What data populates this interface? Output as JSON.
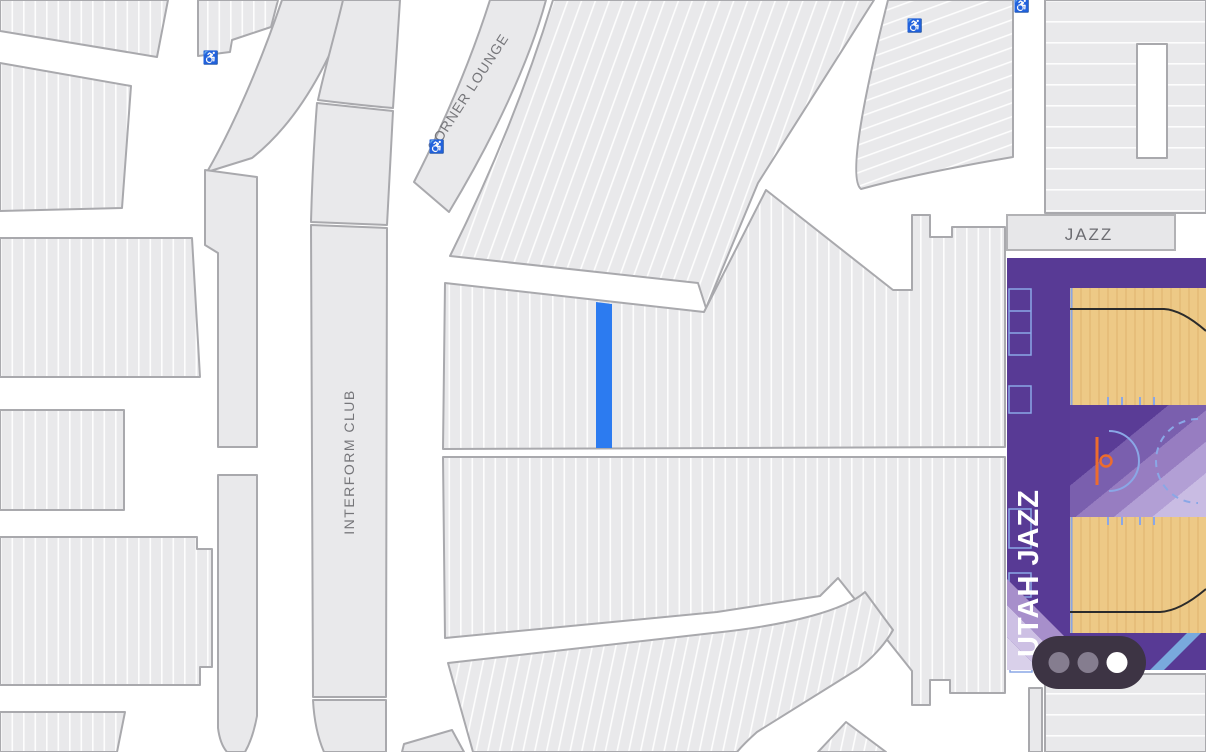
{
  "labels": {
    "corner_lounge": "CORNER LOUNGE",
    "interform_club": "INTERFORM CLUB",
    "court_end_zone": "JAZZ",
    "court_team": "UTAH JAZZ"
  },
  "icons": {
    "wheelchair_glyph": "♿"
  },
  "pager": {
    "dot_count": 3,
    "active_dot_index": 2
  },
  "selection": {
    "selected_row_color": "#2c7bf0"
  },
  "colors": {
    "section_fill": "#e9e9eb",
    "section_border": "#a9a9ad",
    "row_line": "#ffffff",
    "court_purple": "#583a95",
    "court_floor": "#edc986",
    "court_accent": "#8aa7e6",
    "three_point_line": "#2b2b2b",
    "hoop_orange": "#ed6c2d",
    "corner_stripe_blue": "#79a9dd",
    "pill_bg": "#3d3444",
    "pill_dot_inactive": "#857d8f",
    "pill_dot_active": "#ffffff",
    "label_text": "#76767a",
    "team_text": "#ffffff"
  }
}
